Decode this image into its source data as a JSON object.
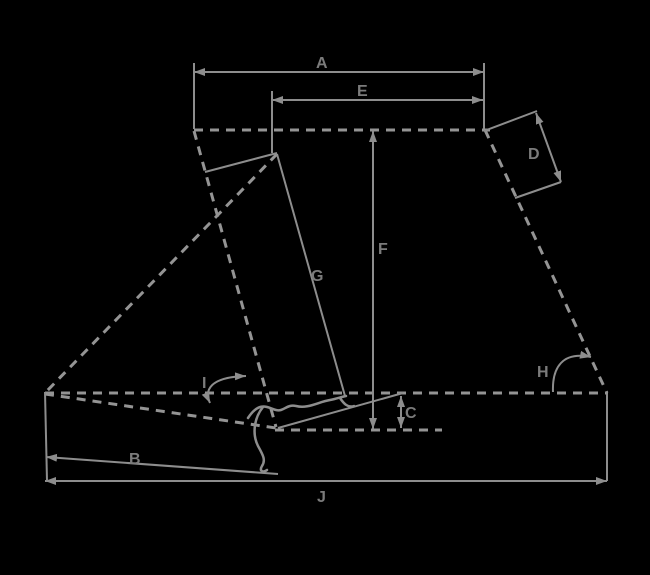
{
  "diagram": {
    "kind": "bicycle-frame-geometry-diagram",
    "background_color": "#000000",
    "dashed_line_color": "#949494",
    "dimension_line_color": "#8d8d8d",
    "label_color": "#7b7b7b",
    "labels": {
      "A": "A",
      "B": "B",
      "C": "C",
      "D": "D",
      "E": "E",
      "F": "F",
      "G": "G",
      "H": "H",
      "I": "I",
      "J": "J"
    }
  }
}
